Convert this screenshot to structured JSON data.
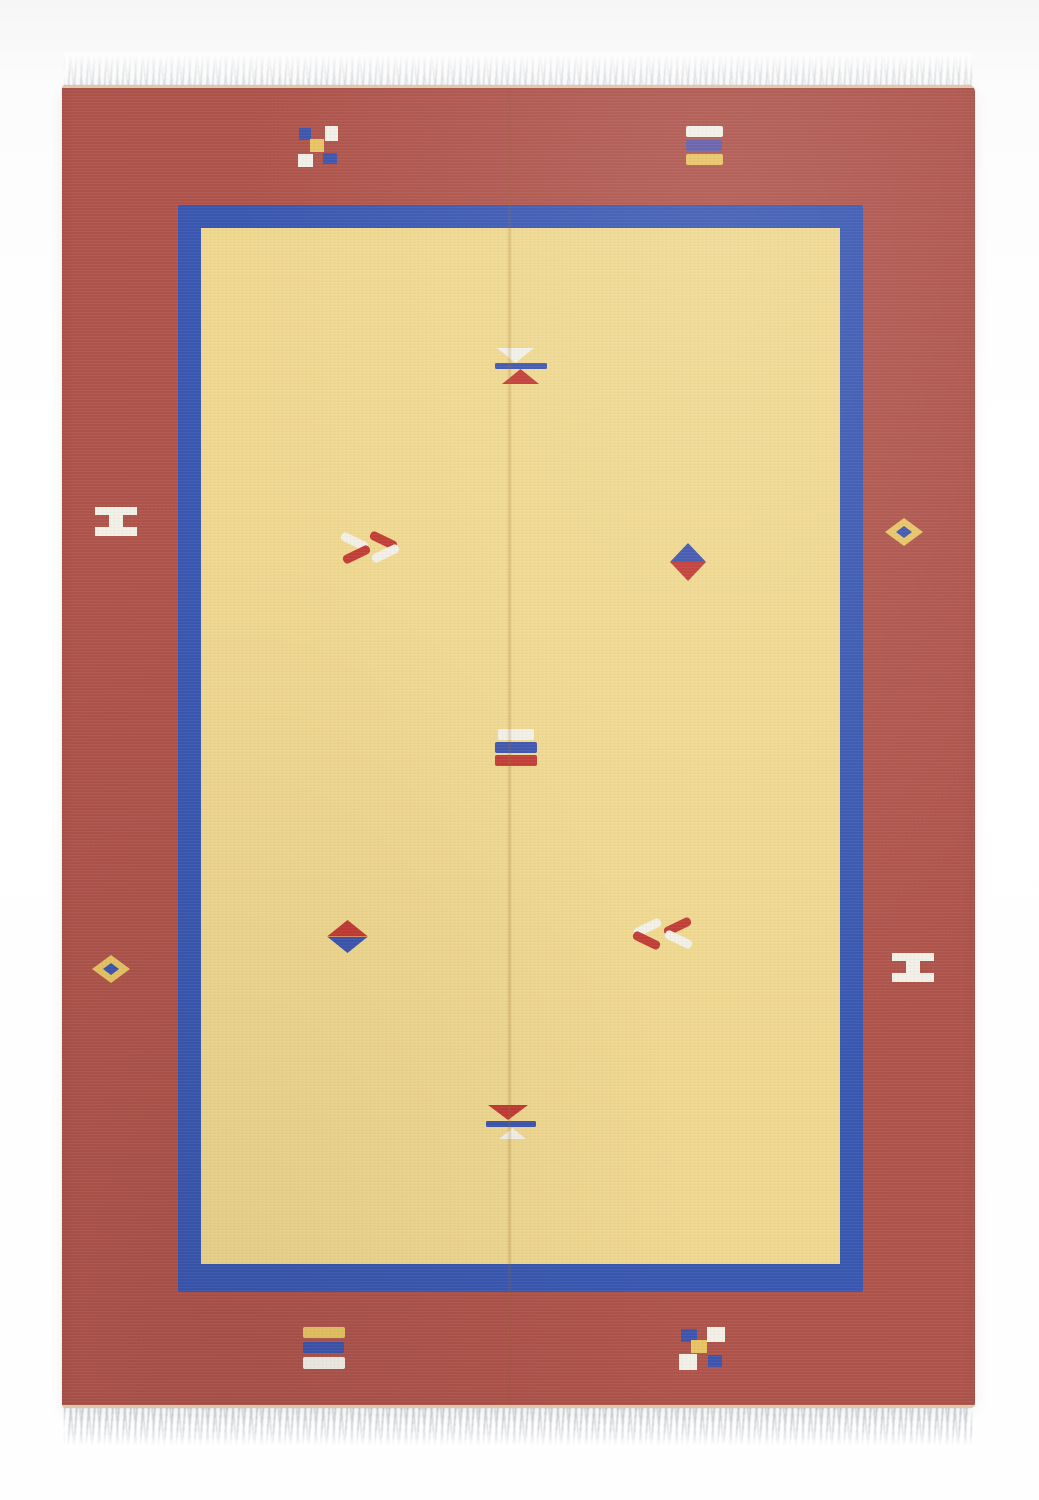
{
  "image": {
    "subject": "Handwoven flat-weave kilim rug photographed on a white background, portrait orientation, with white fringe at top and bottom",
    "style": "terracotta red outer border, royal blue inner frame, pale yellow field, small geometric pick motifs"
  },
  "colors": {
    "red_border": "#af544b",
    "blue_border": "#3a58b2",
    "yellow_field": "#f0d88f",
    "motif_white": "#f3f0e8",
    "motif_red": "#c23b34",
    "motif_blue": "#3d55ae",
    "motif_violet": "#6059a8",
    "motif_yellow": "#e8c464",
    "fringe": "#c9ccd1",
    "selvedge": "#e9dcbb"
  },
  "motifs": {
    "checker_top_left": "five-square checkerboard: blue, white, yellow center, white, blue",
    "stripes_top_right": "three bars: white, violet-blue, yellow",
    "hourglass_top": "hourglass: white triangle over blue bar over red triangle",
    "h_left": "white sideways H / I-beam symbol",
    "chevrons_right": "double chevron pointing right, white and red strokes",
    "diamond_right_border": "yellow diamond with blue center",
    "diamond_blue_red": "diamond: blue top half, red bottom half",
    "stripes_center": "three bars: white, blue, red",
    "diamond_left_border": "yellow diamond with blue center",
    "diamond_red_blue": "diamond: red top half, blue bottom half",
    "chevrons_left": "double chevron pointing left, red and white strokes",
    "h_right": "white sideways H / I-beam symbol",
    "hourglass_bottom": "hourglass: red triangle over blue bar over white triangle",
    "stripes_bottom_left": "three bars: yellow, blue, white",
    "checker_bottom_right": "five-square checkerboard: blue, white, yellow center, white, blue"
  }
}
